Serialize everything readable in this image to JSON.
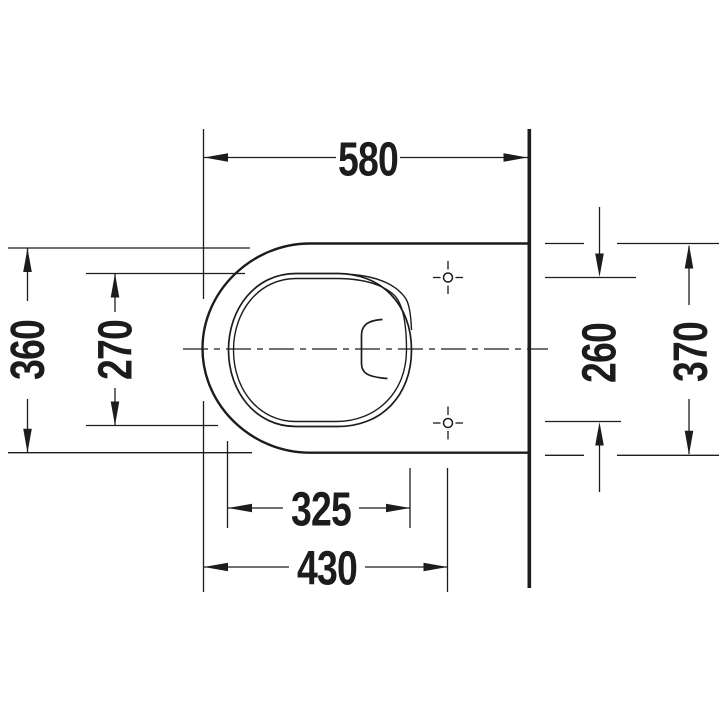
{
  "colors": {
    "line": "#1c1c1c",
    "background": "#ffffff"
  },
  "drawing": {
    "labels": {
      "overall_depth": "580",
      "outer_width": "360",
      "bowl_inner_width": "270",
      "bowl_inner_length": "325",
      "front_to_fixing_holes": "430",
      "fixing_hole_spacing": "260",
      "body_width_at_wall": "370"
    }
  }
}
